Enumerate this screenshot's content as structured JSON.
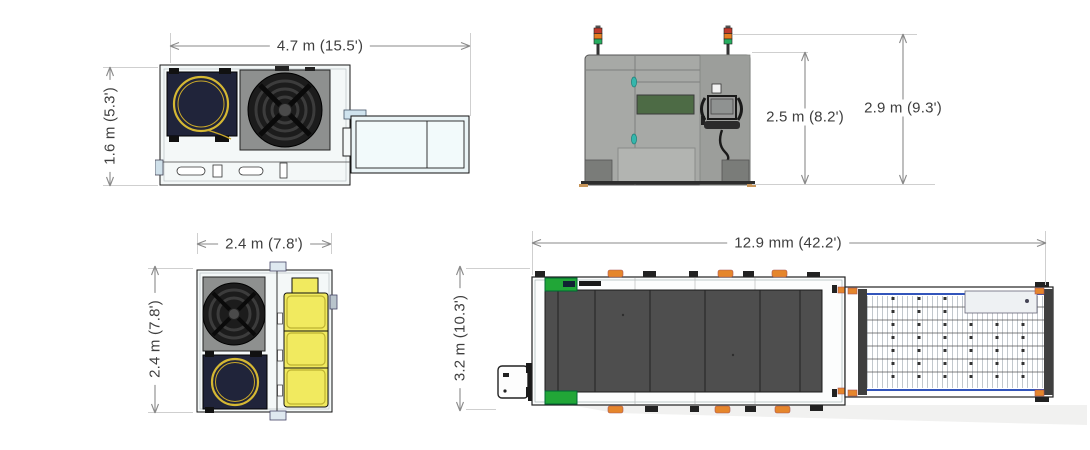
{
  "diagram": {
    "views": {
      "source_unit_top": {
        "width": "4.7 m (15.5')",
        "depth": "1.6 m (5.3')"
      },
      "machine_front": {
        "body_height": "2.5 m (8.2')",
        "total_height": "2.9 m (9.3')"
      },
      "chiller_top": {
        "width": "2.4 m (7.8')",
        "depth": "2.4 m (7.8')"
      },
      "machine_top": {
        "length": "12.9 mm (42.2')",
        "width": "3.2 m (10.3')"
      }
    },
    "colors": {
      "dimension_text": "#3e3e3e",
      "dimension_line": "#8a8a8a",
      "extension_line": "#cfcfcf",
      "machine_body": "#f4f8f8",
      "cabinet_gray": "#a7a9a6",
      "window_green": "#4d6b45",
      "handle_teal": "#35b6ac",
      "tower_red": "#c0392b",
      "tower_amber": "#e67e22",
      "tower_green": "#27ae60",
      "coil_yellow": "#d5b833",
      "tank_yellow": "#f1ea5f",
      "panel_dark": "#4e4e4e",
      "accent_green": "#21a637",
      "clamp_orange": "#e5862c",
      "edge_blue": "#3355bb"
    }
  }
}
